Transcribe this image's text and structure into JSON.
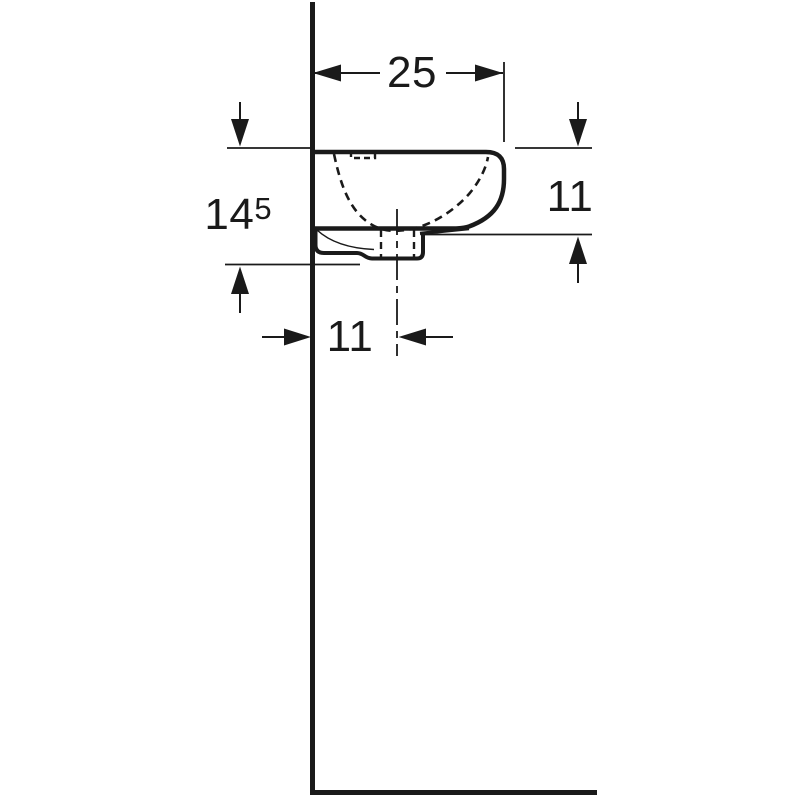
{
  "drawing": {
    "labels": {
      "top_width": "25",
      "left_height_main": "14",
      "left_height_sup": "5",
      "right_height": "11",
      "bottom_offset": "11"
    },
    "colors": {
      "line": "#1a1a1a",
      "background": "#ffffff"
    }
  }
}
